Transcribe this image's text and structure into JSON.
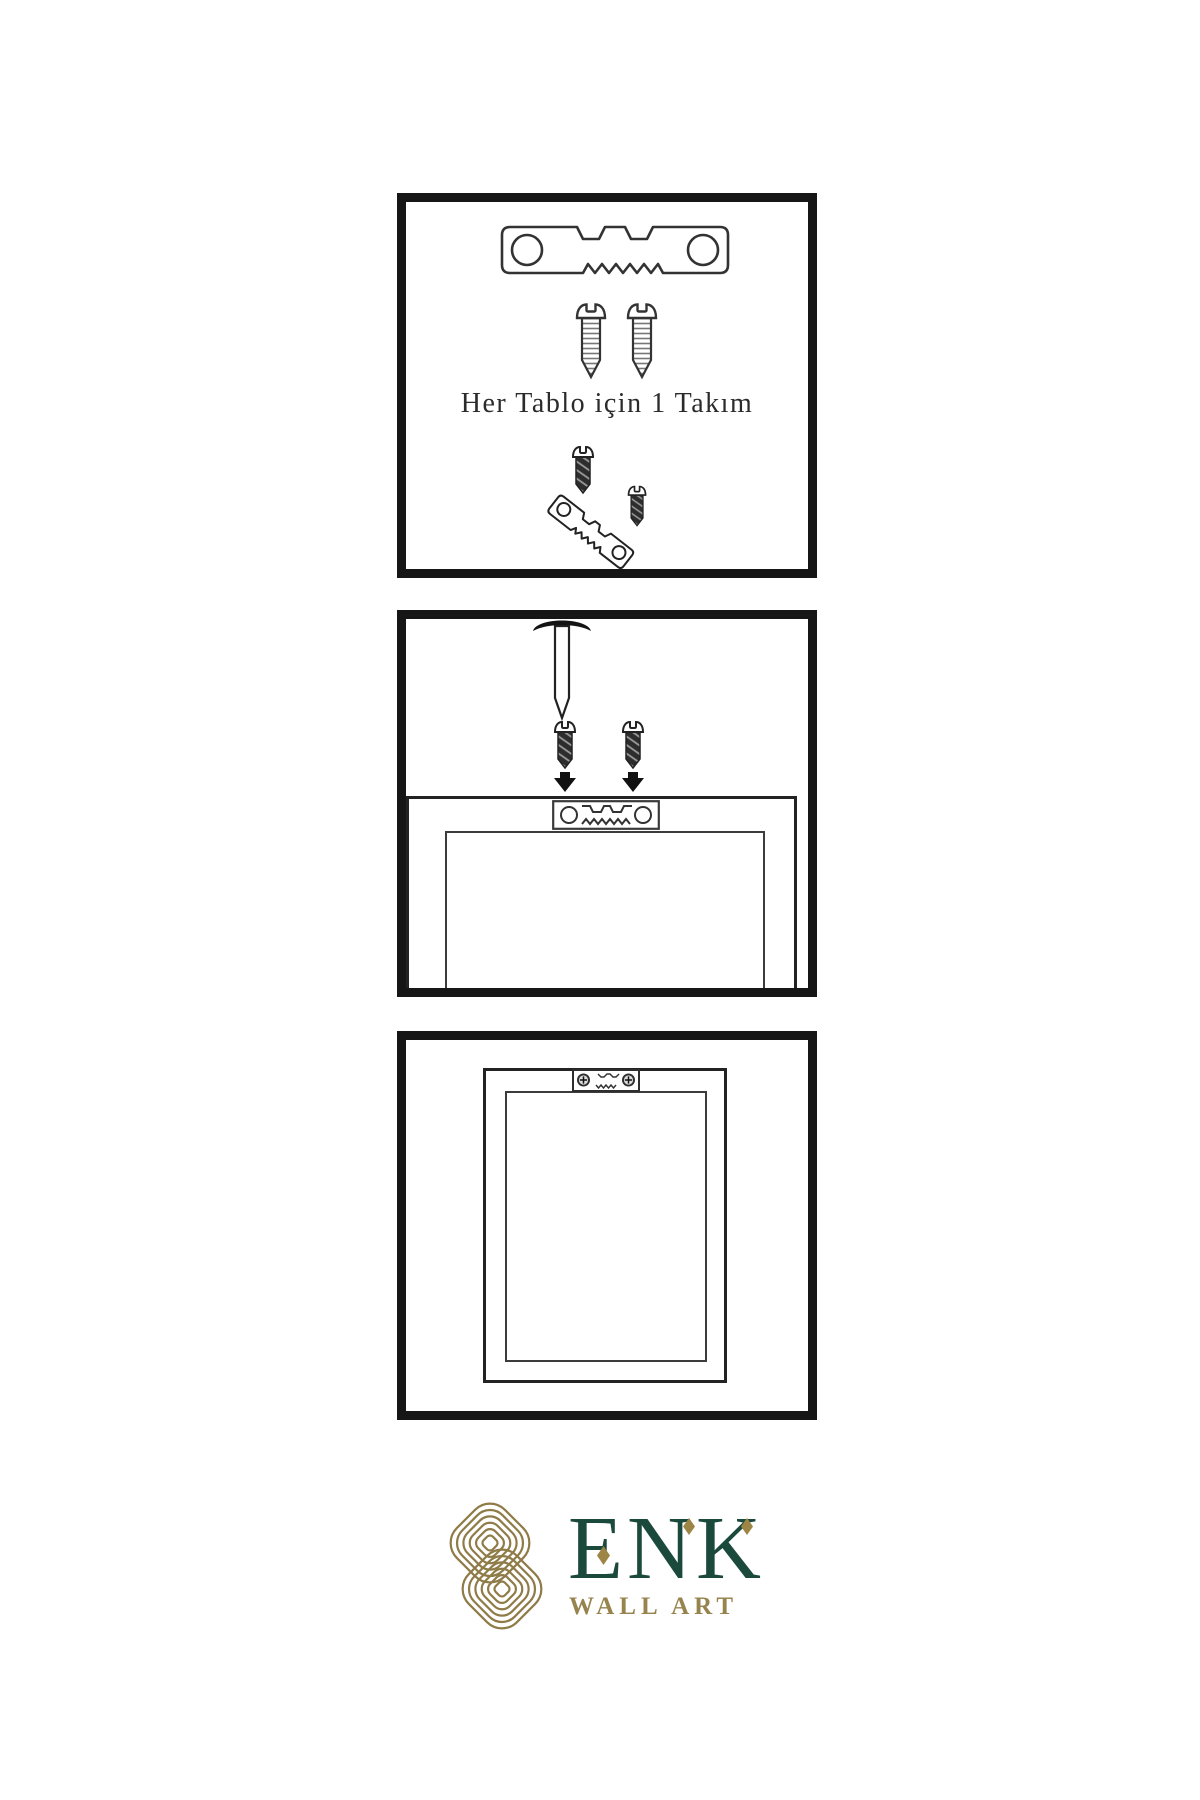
{
  "instruction": {
    "kit_label": "Her Tablo için 1 Takım"
  },
  "brand": {
    "name": "ENK",
    "subtitle": "WALL ART",
    "green": "#1b4a3c",
    "gold": "#8e7b47"
  },
  "panels": [
    {
      "id": "hardware-kit",
      "items": [
        "sawtooth-hanger-icon",
        "screw-icon",
        "screw-icon",
        "screw-into-hanger-icon"
      ]
    },
    {
      "id": "wall-mounting",
      "items": [
        "nail-in-wall-icon",
        "screw-down-arrow-icon",
        "screw-down-arrow-icon",
        "frame-back-with-hanger-icon"
      ]
    },
    {
      "id": "hung-frame",
      "items": [
        "frame-with-mounted-hanger-icon"
      ]
    }
  ],
  "colors": {
    "background": "#ffffff",
    "panel_border": "#161616",
    "line_art": "#333333"
  }
}
